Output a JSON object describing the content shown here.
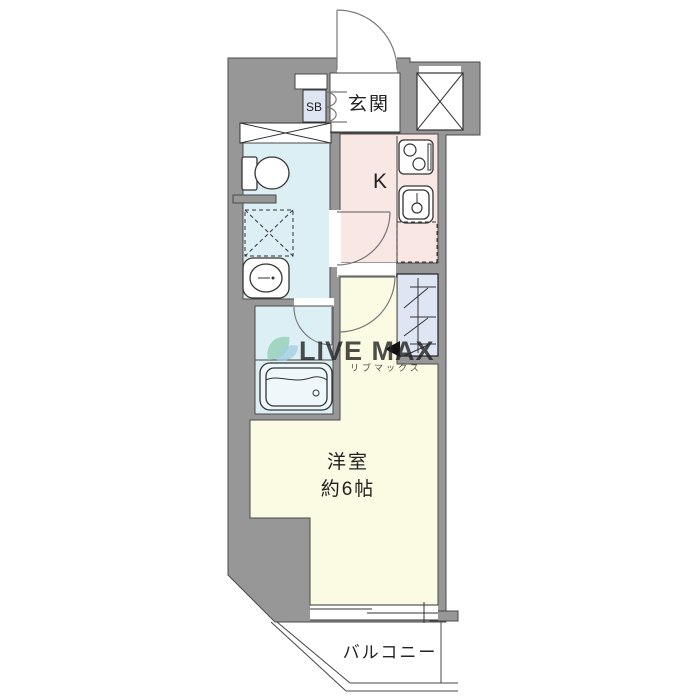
{
  "floorplan": {
    "rooms": {
      "entrance_label": "玄関",
      "shoe_box_label": "SB",
      "kitchen_label": "K",
      "main_room_label_line1": "洋室",
      "main_room_label_line2": "約6帖",
      "balcony_label": "バルコニー"
    },
    "watermark": {
      "text": "LIVE MAX",
      "subtext": "リブマックス"
    },
    "colors": {
      "wall": "#979797",
      "wet_area": "#dbeff5",
      "kitchen": "#f9e7e3",
      "main_room": "#fbfae2",
      "closet": "#dfe6f3",
      "shoe_box": "#dfe6f3",
      "white": "#ffffff",
      "watermark_blue": "#aiceeo"
    }
  }
}
